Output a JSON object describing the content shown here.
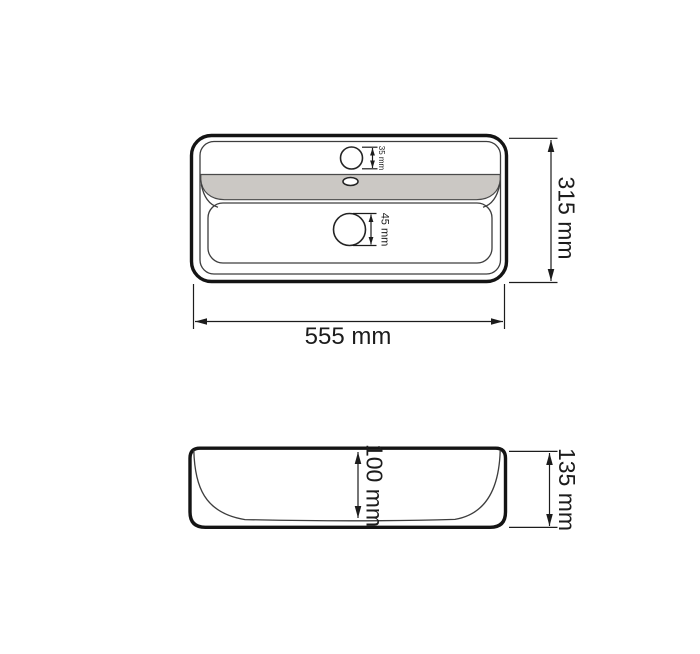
{
  "drawing": {
    "subject": "rectangular washbasin technical dimension drawing",
    "colors": {
      "background": "#ffffff",
      "outline": "#141414",
      "thin_line": "#3d3d3d",
      "dim_line": "#1c1c1c",
      "deck_fill": "#cbc8c4"
    },
    "top_view": {
      "width_dim": "555 mm",
      "depth_dim": "315 mm",
      "faucet_hole_dim": "35 mm",
      "drain_hole_dim": "45 mm"
    },
    "side_view": {
      "height_dim": "135 mm",
      "inner_depth_dim": "100 mm"
    }
  }
}
